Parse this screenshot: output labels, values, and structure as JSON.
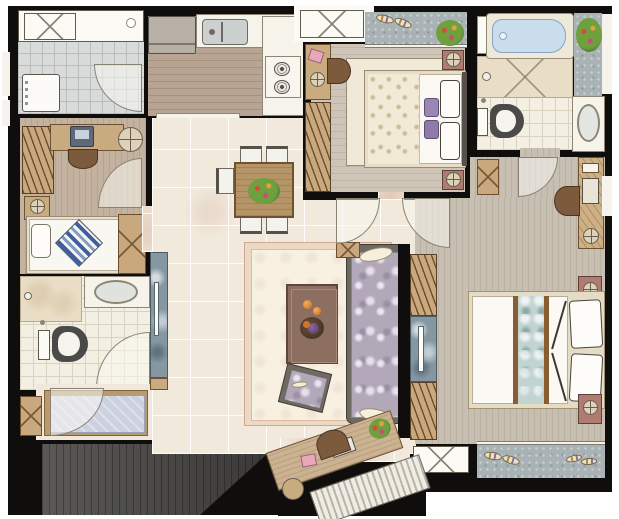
{
  "title": "Apartment floor plan – watercolor style rendering, top-down view",
  "colors": {
    "walls": "#0f0e0c",
    "marble_floor": "#f0e9dc",
    "wood_floor": "#b7a492",
    "bedroom_floor": "#c8bfb3",
    "grey_tile": "#d8dbda",
    "bath_tile": "#f3efe2",
    "balcony_grey": "#a9b2b4",
    "cabinet_tan": "#c9a87e",
    "nightstand_mauve": "#b07c72",
    "sofa_damask": "#b2a8ba",
    "bathtub_blue": "#c9ddec",
    "tv_wall_marble": "#8497a3",
    "entry_rug_blue": "#ccd1df",
    "outside_shadow": "#4a4947"
  },
  "rooms": [
    {
      "name": "utility balcony",
      "position": "top-left",
      "floor": "grey tile",
      "fixtures": [
        "ac-outdoor-unit",
        "louver-window",
        "floor-drain",
        "washing-machine",
        "door-swing"
      ]
    },
    {
      "name": "kitchen",
      "position": "top-center-left",
      "floor": "wood plank",
      "fixtures": [
        "refrigerator",
        "l-shaped-counter",
        "double-basin-sink",
        "two-burner-cooktop",
        "serving-hatch"
      ],
      "burner_count": 2
    },
    {
      "name": "study bedroom 3",
      "position": "mid-left",
      "floor": "wood plank",
      "furniture": [
        "hanger-wardrobe",
        "desk-with-monitor",
        "desk-chair",
        "round-side-table",
        "single-bed",
        "pillow",
        "blue-striped-cushion",
        "bedside-cabinet",
        "x-wardrobe"
      ]
    },
    {
      "name": "bathroom 2",
      "position": "lower-left",
      "floor": "white tile",
      "fixtures": [
        "shower-area",
        "vanity-basin",
        "toilet",
        "door-swing",
        "floor-drain"
      ]
    },
    {
      "name": "entry foyer",
      "position": "bottom-left",
      "floor": "marble",
      "fixtures": [
        "patterned-rug",
        "entry-door-swing",
        "x-column"
      ]
    },
    {
      "name": "dining area",
      "position": "center",
      "floor": "marble tile",
      "furniture": [
        "dining-table",
        "flower-centerpiece",
        "dining-chairs"
      ],
      "chair_count": 5
    },
    {
      "name": "living room",
      "position": "center",
      "floor": "marble tile",
      "furniture": [
        "area-rug",
        "coffee-table",
        "fruit-tray",
        "damask-sofa",
        "feather-pillows",
        "accent-ottoman",
        "tv-feature-wall",
        "wall-mounted-tv",
        "console-desk",
        "laptop",
        "book",
        "potted-plant",
        "round-stool",
        "entrance-steps"
      ]
    },
    {
      "name": "bedroom 2",
      "position": "top-center-right",
      "floor": "wood plank",
      "furniture": [
        "double-bed",
        "floral-duvet",
        "pillows",
        "purple-cushions",
        "area-rug",
        "nightstands-with-lamps",
        "desk",
        "chair",
        "pink-book",
        "hanger-wardrobe"
      ],
      "balcony_items": [
        "slippers",
        "potted-plant",
        "ac-outdoor-unit"
      ]
    },
    {
      "name": "master bathroom",
      "position": "top-right",
      "floor": "white tile",
      "fixtures": [
        "bathtub",
        "shower-area-cross-marked",
        "shower-head",
        "toilet",
        "vanity-basin",
        "planter-with-flowers",
        "door-swing"
      ]
    },
    {
      "name": "master bedroom",
      "position": "right",
      "floor": "wood plank",
      "furniture": [
        "double-bed",
        "teal-scroll-runner",
        "pillows",
        "headboard-drape",
        "nightstands-with-lamps",
        "vanity-with-mirror",
        "vanity-stool",
        "hanger-wardrobe-with-tv-niche",
        "x-column"
      ],
      "balcony_items": [
        "slippers",
        "ac-outdoor-unit"
      ]
    },
    {
      "name": "hallway",
      "position": "center-right",
      "floor": "marble tile",
      "fixtures": [
        "bedroom2-door-swing",
        "master-door-swing",
        "low-x-cabinet"
      ]
    }
  ]
}
